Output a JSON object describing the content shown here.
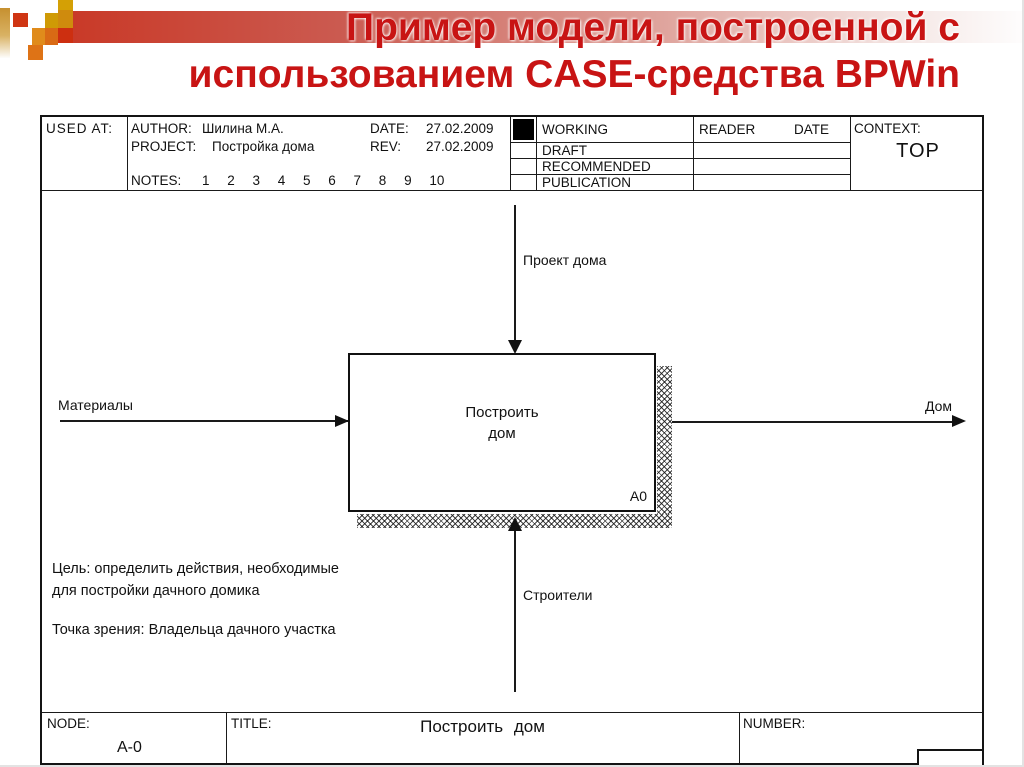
{
  "slide_title": {
    "line1": "Пример модели, построенной с",
    "line2": "использованием CASE-средства BPWin"
  },
  "kit_header": {
    "used_at_label": "USED AT:",
    "author_label": "AUTHOR:",
    "author": "Шилина М.А.",
    "date_label": "DATE:",
    "date": "27.02.2009",
    "project_label": "PROJECT:",
    "project": "Постройка дома",
    "rev_label": "REV:",
    "rev": "27.02.2009",
    "notes_label": "NOTES:",
    "notes": "1 2 3 4 5 6 7 8 9 10",
    "status_rows": [
      "WORKING",
      "DRAFT",
      "RECOMMENDED",
      "PUBLICATION"
    ],
    "checked_status": "WORKING",
    "reader_label": "READER",
    "reader_date_label": "DATE",
    "context_label": "CONTEXT:",
    "context_value": "TOP"
  },
  "diagram": {
    "activity": {
      "name_line1": "Построить",
      "name_line2": "дом",
      "code": "A0"
    },
    "control_label": "Проект дома",
    "input_label": "Материалы",
    "output_label": "Дом",
    "mechanism_label": "Строители",
    "goal_line1": "Цель: определить действия, необходимые",
    "goal_line2": "для постройки дачного домика",
    "viewpoint": "Точка зрения: Владельца дачного участка"
  },
  "kit_footer": {
    "node_label": "NODE:",
    "node": "A-0",
    "title_label": "TITLE:",
    "title": "Построить дом",
    "number_label": "NUMBER:"
  },
  "colors": {
    "title_red": "#c81414",
    "band_red": "#c93a28",
    "accent_gold": "#cf9a05",
    "line_black": "#1a1a1a"
  }
}
